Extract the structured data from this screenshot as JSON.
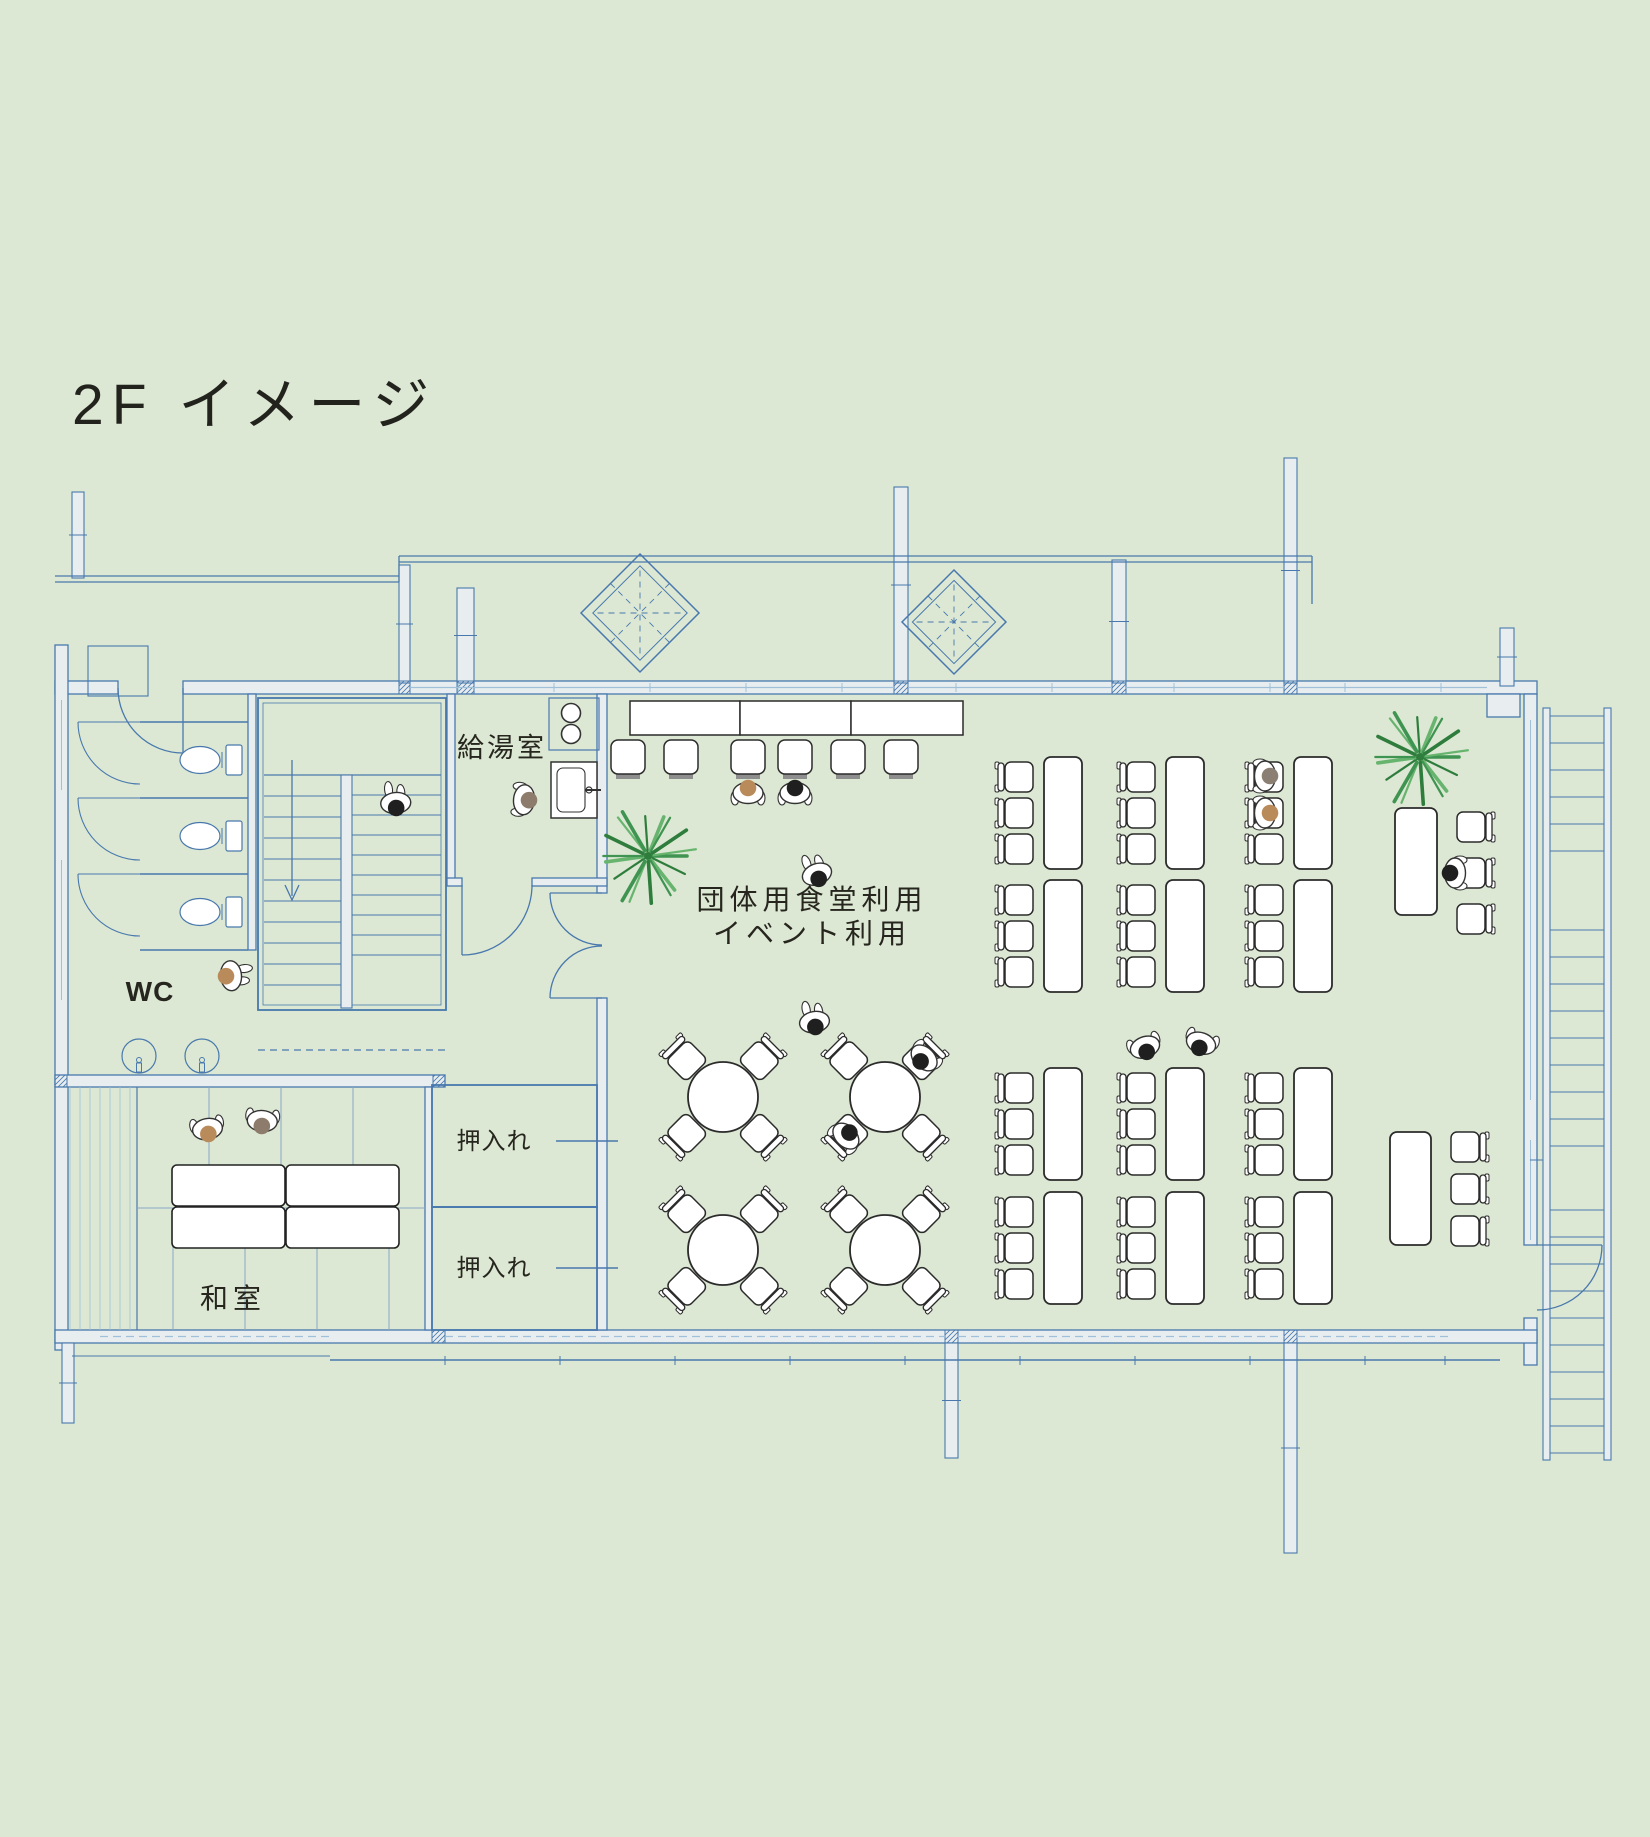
{
  "title": "2F イメージ",
  "rooms": {
    "wc": {
      "label": "WC"
    },
    "kitchenette": {
      "label": "給湯室"
    },
    "closet_upper": {
      "label": "押入れ"
    },
    "closet_lower": {
      "label": "押入れ"
    },
    "japanese_room": {
      "label": "和室"
    },
    "main_hall": {
      "label_line1": "団体用食堂利用",
      "label_line2": "イベント利用"
    }
  },
  "colors": {
    "background": "#dce8d3",
    "plan_line": "#4878ad",
    "glazing_line": "#9fc0d8",
    "wall_fill": "#e8eef0",
    "furniture_line": "#2b2b2b",
    "text": "#26261f",
    "plant_green_1": "#3e9450",
    "plant_green_2": "#2f7d3c",
    "plant_green_3": "#67b46f",
    "skin_tan": "#b98b5a",
    "hair_black": "#1f1f1f",
    "hair_brown": "#8d7b6c",
    "hair_gray": "#8a7f72",
    "stool_base": "#8e8e8e"
  },
  "furniture_summary": {
    "long_tables": 14,
    "long_table_chairs": 42,
    "round_tables": 4,
    "round_table_chairs": 16,
    "counter_sections": 3,
    "counter_stools": 6,
    "low_tables_japanese_room": 4,
    "toilet_stalls": 3,
    "wash_basins": 2,
    "plants": 2,
    "people": 16,
    "staircases": 2,
    "skylights": 2
  }
}
